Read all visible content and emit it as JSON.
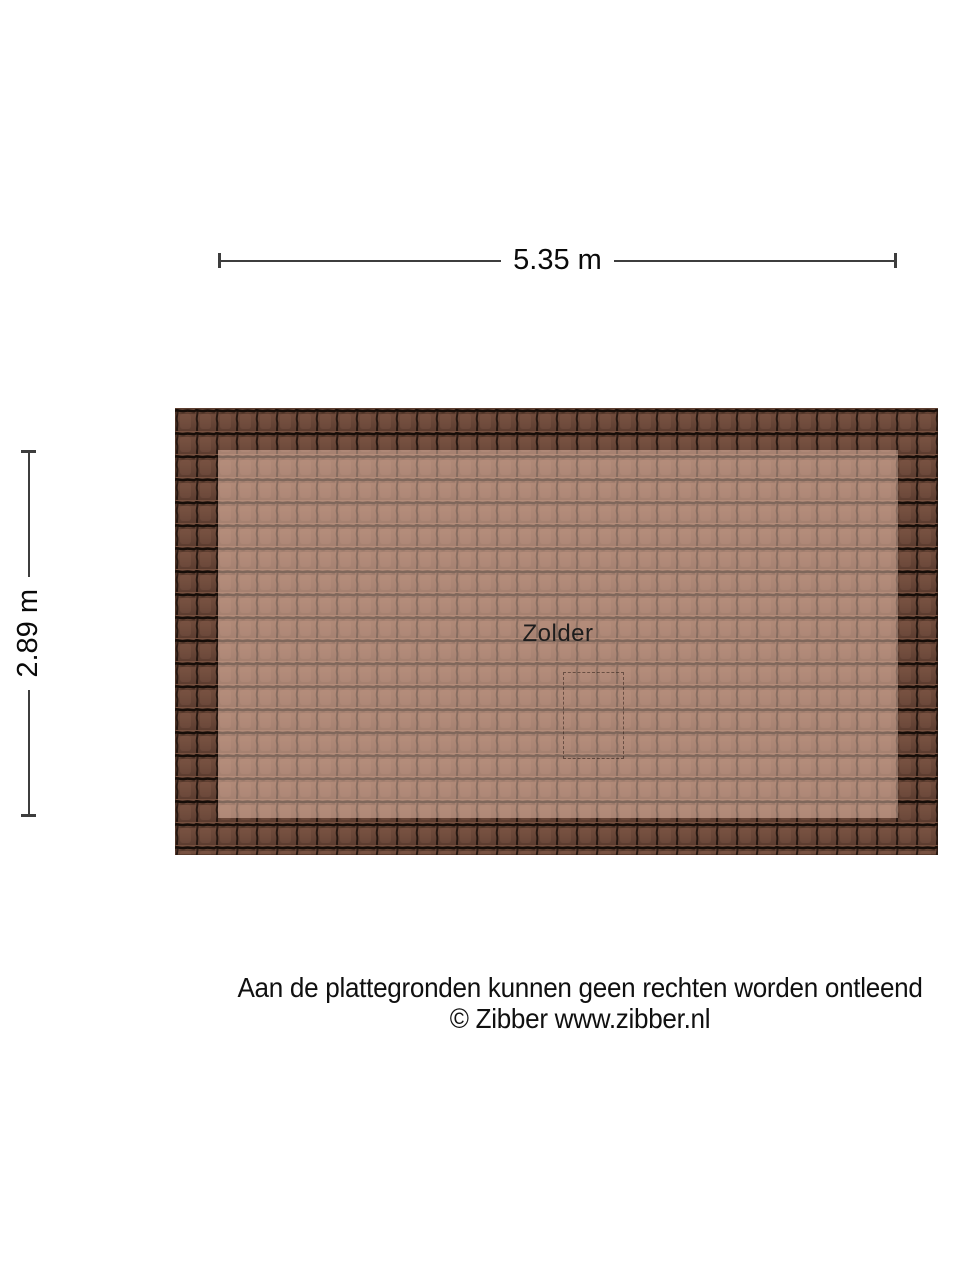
{
  "plan": {
    "room": {
      "label": "Zolder"
    },
    "dimensions": {
      "width_label": "5.35 m",
      "height_label": "2.89 m"
    }
  },
  "footer": {
    "disclaimer": "Aan de plattegronden kunnen geen rechten worden ontleend",
    "copyright": "© Zibber www.zibber.nl"
  },
  "colors": {
    "page-bg": "#ffffff",
    "dim-color": "#3d3d3d",
    "tile-body": "#6b4839",
    "tile-body-light": "#77503f",
    "tile-body-dark": "#5c3d30",
    "tile-groove": "#1a0f0a",
    "tile-lap": "#160d08",
    "room-highlight": "rgba(255,212,194,0.45)"
  }
}
